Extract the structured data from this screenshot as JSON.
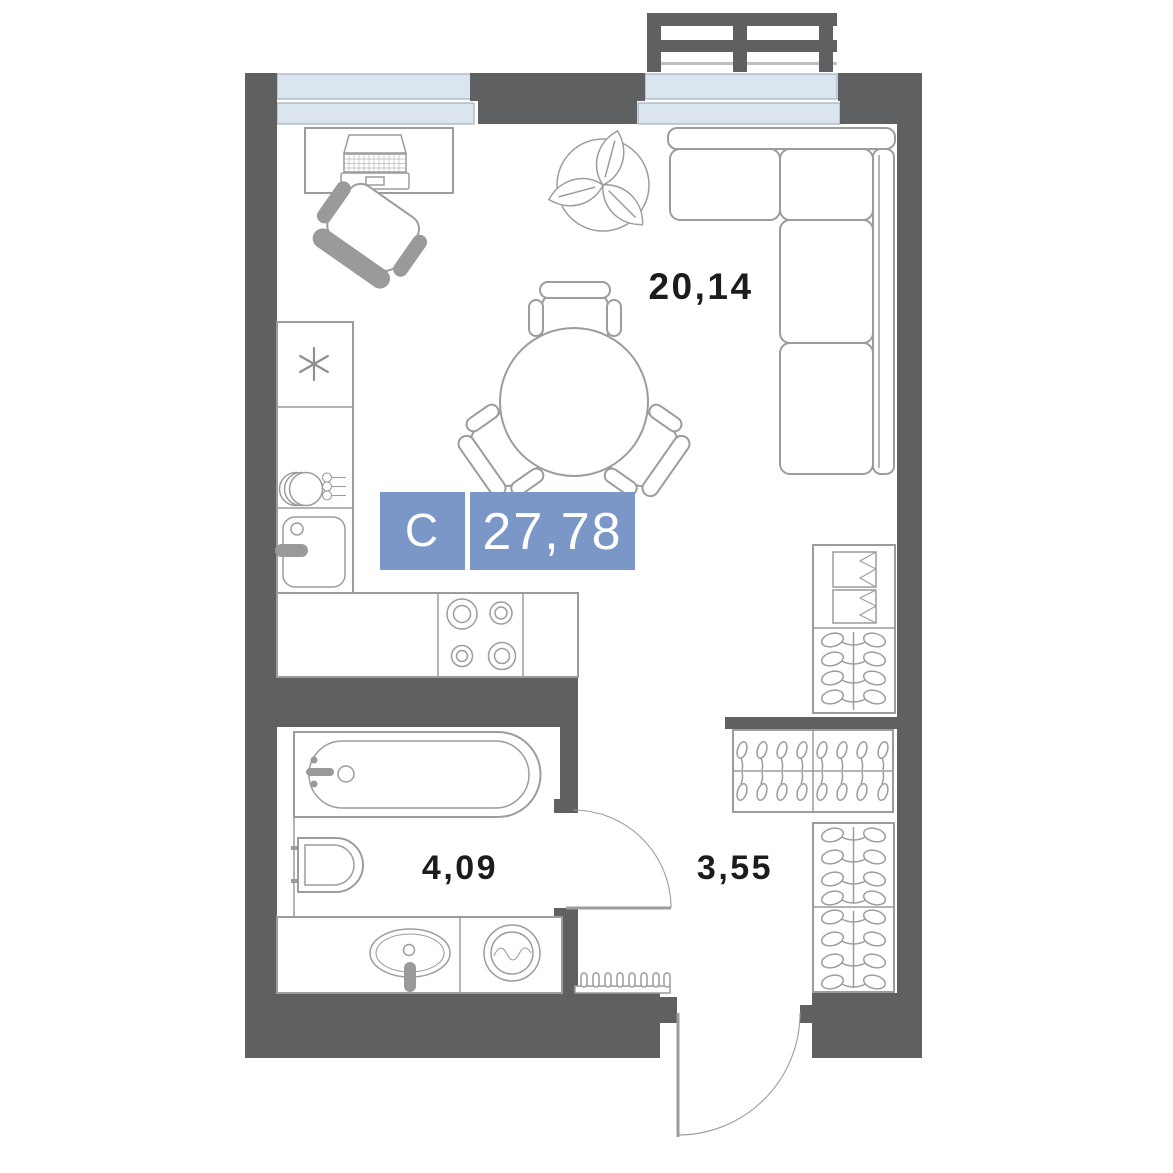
{
  "rooms": {
    "living": {
      "area": "20,14"
    },
    "bathroom": {
      "area": "4,09"
    },
    "hallway": {
      "area": "3,55"
    }
  },
  "badge": {
    "unit_type_letter": "С",
    "total_area": "27,78"
  },
  "colors": {
    "background": "#ffffff",
    "wall": "#5e6062",
    "furniture_line": "#9c9c9c",
    "furniture_fill": "#ffffff",
    "accent_gray": "#9a9a9a",
    "window_fill": "#dbe5f0",
    "window_line": "#a5afbc",
    "badge_blue": "#7b97c8",
    "badge_text": "#ffffff",
    "label_text": "#1c1c1e"
  },
  "furniture_icons": [
    "balcony-railing-icon",
    "window-icon",
    "desk-icon",
    "laptop-icon",
    "office-chair-icon",
    "plant-icon",
    "dining-table-icon",
    "dining-chair-icon",
    "corner-sofa-icon",
    "fridge-icon",
    "dish-shelf-icon",
    "kitchen-sink-icon",
    "stove-icon",
    "wardrobe-shelves-icon",
    "wardrobe-hangers-icon",
    "coat-rack-icon",
    "bathtub-icon",
    "toilet-icon",
    "washbasin-icon",
    "washing-machine-icon",
    "radiator-icon",
    "door-swing-icon"
  ]
}
